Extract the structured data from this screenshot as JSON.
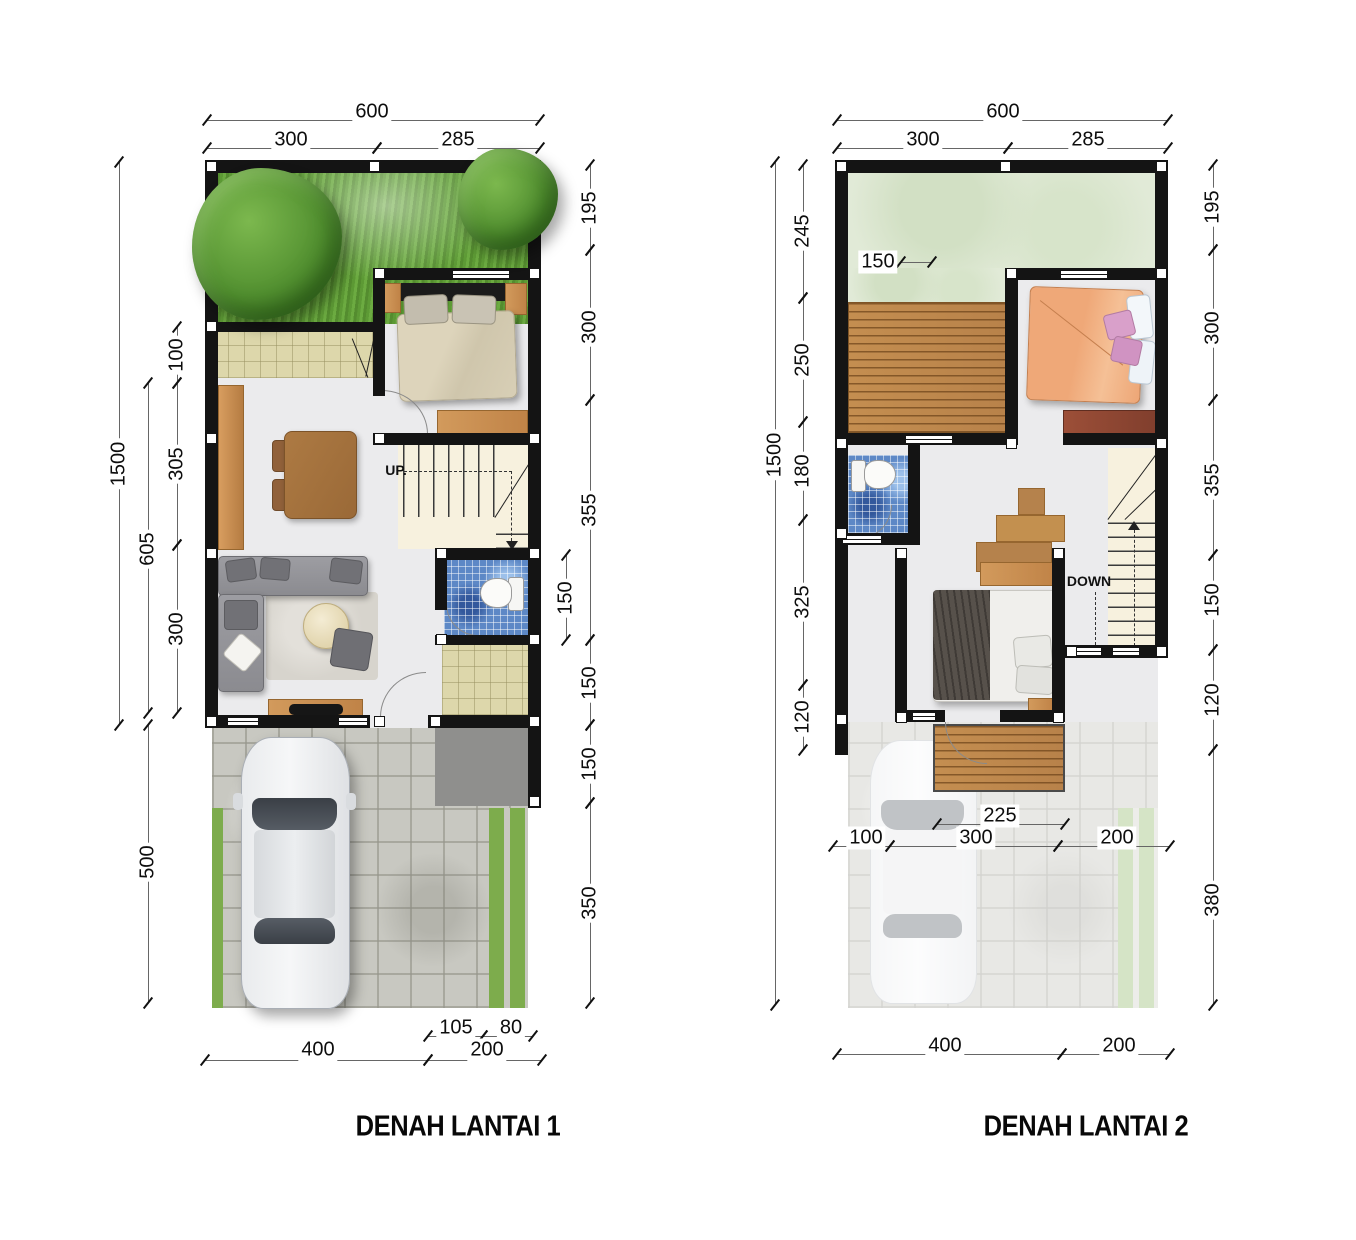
{
  "document": {
    "type": "architectural-floor-plan",
    "language": "Indonesian"
  },
  "plans": [
    {
      "name": "DENAH LANTAI 1",
      "stair_label": "UP."
    },
    {
      "name": "DENAH LANTAI 2",
      "stair_label": "DOWN"
    }
  ],
  "colors": {
    "wall": "#141414",
    "grass": "#64a03c",
    "pale_roof": "#e1ead7",
    "deck_wood": "#c08a4e",
    "bath_tile": "#5d88c6",
    "beige_tile": "#ddd7ab",
    "paver": "#c8c8c1",
    "furniture_wood": "#cd9152",
    "dim_text": "#0d0d0d"
  },
  "titles": [
    {
      "plan": 1,
      "text": "DENAH LANTAI 1",
      "x": 458,
      "y": 1127
    },
    {
      "plan": 2,
      "text": "DENAH LANTAI 2",
      "x": 1086,
      "y": 1127
    }
  ],
  "room_labels": [
    {
      "plan": 1,
      "text": "UP.",
      "x": 396,
      "y": 470
    },
    {
      "plan": 2,
      "text": "DOWN",
      "x": 1089,
      "y": 581
    }
  ],
  "dimensions": [
    {
      "plan": 1,
      "text": "600",
      "x": 372,
      "y": 112,
      "vertical": false,
      "line": [
        207,
        120,
        540,
        120
      ]
    },
    {
      "plan": 1,
      "text": "300",
      "x": 291,
      "y": 140,
      "vertical": false,
      "line": [
        207,
        148,
        377,
        148
      ]
    },
    {
      "plan": 1,
      "text": "285",
      "x": 458,
      "y": 140,
      "vertical": false,
      "line": [
        377,
        148,
        540,
        148
      ]
    },
    {
      "plan": 1,
      "text": "1500",
      "x": 119,
      "y": 464,
      "vertical": true,
      "line": [
        119,
        162,
        119,
        725
      ]
    },
    {
      "plan": 1,
      "text": "100",
      "x": 177,
      "y": 355,
      "vertical": true,
      "line": [
        177,
        327,
        177,
        383
      ]
    },
    {
      "plan": 1,
      "text": "305",
      "x": 177,
      "y": 464,
      "vertical": true,
      "line": [
        177,
        383,
        177,
        545
      ]
    },
    {
      "plan": 1,
      "text": "300",
      "x": 177,
      "y": 629,
      "vertical": true,
      "line": [
        177,
        545,
        177,
        713
      ]
    },
    {
      "plan": 1,
      "text": "605",
      "x": 148,
      "y": 549,
      "vertical": true,
      "line": [
        148,
        383,
        148,
        713
      ]
    },
    {
      "plan": 1,
      "text": "500",
      "x": 148,
      "y": 862,
      "vertical": true,
      "line": [
        148,
        725,
        148,
        1003
      ]
    },
    {
      "plan": 1,
      "text": "195",
      "x": 590,
      "y": 208,
      "vertical": true,
      "line": [
        590,
        165,
        590,
        250
      ]
    },
    {
      "plan": 1,
      "text": "300",
      "x": 590,
      "y": 327,
      "vertical": true,
      "line": [
        590,
        250,
        590,
        400
      ]
    },
    {
      "plan": 1,
      "text": "355",
      "x": 590,
      "y": 510,
      "vertical": true,
      "line": [
        590,
        400,
        590,
        640
      ]
    },
    {
      "plan": 1,
      "text": "150",
      "x": 566,
      "y": 598,
      "vertical": true,
      "line": [
        566,
        555,
        566,
        640
      ]
    },
    {
      "plan": 1,
      "text": "150",
      "x": 590,
      "y": 683,
      "vertical": true,
      "line": [
        590,
        640,
        590,
        725
      ]
    },
    {
      "plan": 1,
      "text": "150",
      "x": 590,
      "y": 764,
      "vertical": true,
      "line": [
        590,
        725,
        590,
        803
      ]
    },
    {
      "plan": 1,
      "text": "350",
      "x": 590,
      "y": 903,
      "vertical": true,
      "line": [
        590,
        803,
        590,
        1003
      ]
    },
    {
      "plan": 1,
      "text": "105",
      "x": 456,
      "y": 1028,
      "vertical": false,
      "line": [
        428,
        1036,
        483,
        1036
      ]
    },
    {
      "plan": 1,
      "text": "80",
      "x": 511,
      "y": 1028,
      "vertical": false,
      "line": [
        483,
        1036,
        533,
        1036
      ]
    },
    {
      "plan": 1,
      "text": "400",
      "x": 318,
      "y": 1050,
      "vertical": false,
      "line": [
        205,
        1060,
        428,
        1060
      ]
    },
    {
      "plan": 1,
      "text": "200",
      "x": 487,
      "y": 1050,
      "vertical": false,
      "line": [
        428,
        1060,
        542,
        1060
      ]
    },
    {
      "plan": 2,
      "text": "600",
      "x": 1003,
      "y": 112,
      "vertical": false,
      "line": [
        837,
        120,
        1168,
        120
      ]
    },
    {
      "plan": 2,
      "text": "300",
      "x": 923,
      "y": 140,
      "vertical": false,
      "line": [
        837,
        148,
        1008,
        148
      ]
    },
    {
      "plan": 2,
      "text": "285",
      "x": 1088,
      "y": 140,
      "vertical": false,
      "line": [
        1008,
        148,
        1168,
        148
      ]
    },
    {
      "plan": 2,
      "text": "1500",
      "x": 775,
      "y": 455,
      "vertical": true,
      "line": [
        775,
        162,
        775,
        1005
      ]
    },
    {
      "plan": 2,
      "text": "245",
      "x": 803,
      "y": 231,
      "vertical": true,
      "line": [
        803,
        165,
        803,
        298
      ]
    },
    {
      "plan": 2,
      "text": "250",
      "x": 803,
      "y": 360,
      "vertical": true,
      "line": [
        803,
        298,
        803,
        422
      ]
    },
    {
      "plan": 2,
      "text": "180",
      "x": 803,
      "y": 471,
      "vertical": true,
      "line": [
        803,
        422,
        803,
        520
      ]
    },
    {
      "plan": 2,
      "text": "325",
      "x": 803,
      "y": 602,
      "vertical": true,
      "line": [
        803,
        520,
        803,
        685
      ]
    },
    {
      "plan": 2,
      "text": "120",
      "x": 803,
      "y": 717,
      "vertical": true,
      "line": [
        803,
        685,
        803,
        750
      ]
    },
    {
      "plan": 2,
      "text": "195",
      "x": 1213,
      "y": 207,
      "vertical": true,
      "line": [
        1213,
        165,
        1213,
        250
      ]
    },
    {
      "plan": 2,
      "text": "300",
      "x": 1213,
      "y": 328,
      "vertical": true,
      "line": [
        1213,
        250,
        1213,
        400
      ]
    },
    {
      "plan": 2,
      "text": "355",
      "x": 1213,
      "y": 480,
      "vertical": true,
      "line": [
        1213,
        400,
        1213,
        555
      ]
    },
    {
      "plan": 2,
      "text": "150",
      "x": 1213,
      "y": 600,
      "vertical": true,
      "line": [
        1213,
        555,
        1213,
        650
      ]
    },
    {
      "plan": 2,
      "text": "120",
      "x": 1213,
      "y": 700,
      "vertical": true,
      "line": [
        1213,
        650,
        1213,
        750
      ]
    },
    {
      "plan": 2,
      "text": "380",
      "x": 1213,
      "y": 900,
      "vertical": true,
      "line": [
        1213,
        750,
        1213,
        1005
      ]
    },
    {
      "plan": 2,
      "text": "150",
      "x": 878,
      "y": 262,
      "vertical": false,
      "line": [
        901,
        262,
        932,
        262
      ]
    },
    {
      "plan": 2,
      "text": "225",
      "x": 1000,
      "y": 816,
      "vertical": false,
      "line": [
        937,
        824,
        1065,
        824
      ]
    },
    {
      "plan": 2,
      "text": "100",
      "x": 866,
      "y": 838,
      "vertical": false,
      "line": [
        833,
        846,
        890,
        846
      ]
    },
    {
      "plan": 2,
      "text": "300",
      "x": 976,
      "y": 838,
      "vertical": false,
      "line": [
        890,
        846,
        1058,
        846
      ]
    },
    {
      "plan": 2,
      "text": "200",
      "x": 1117,
      "y": 838,
      "vertical": false,
      "line": [
        1058,
        846,
        1170,
        846
      ]
    },
    {
      "plan": 2,
      "text": "400",
      "x": 945,
      "y": 1046,
      "vertical": false,
      "line": [
        837,
        1054,
        1062,
        1054
      ]
    },
    {
      "plan": 2,
      "text": "200",
      "x": 1119,
      "y": 1046,
      "vertical": false,
      "line": [
        1062,
        1054,
        1170,
        1054
      ]
    }
  ]
}
